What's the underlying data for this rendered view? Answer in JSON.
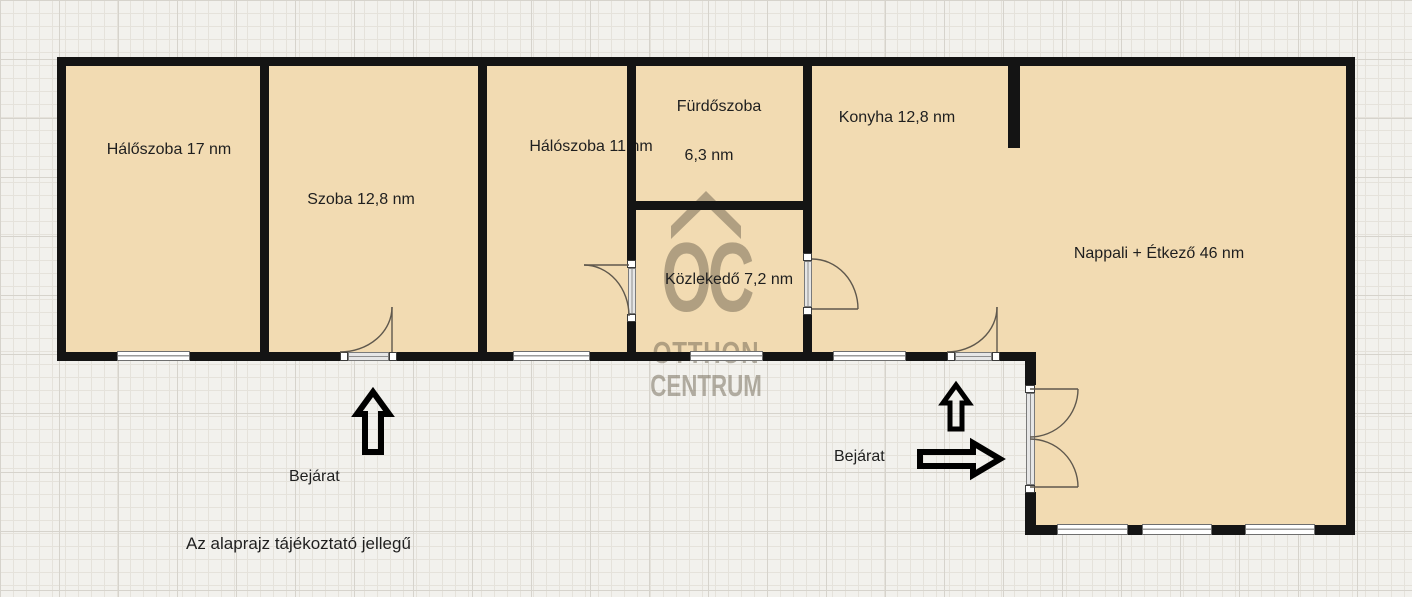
{
  "rooms": {
    "halo17": {
      "label": "Hálőszoba 17 nm"
    },
    "szoba": {
      "label": "Szoba 12,8 nm"
    },
    "halo11": {
      "label": "Hálószoba 11 nm"
    },
    "furdo": {
      "label": "Fürdőszoba",
      "area": "6,3 nm"
    },
    "konyha": {
      "label": "Konyha 12,8 nm"
    },
    "kozlekedo": {
      "label": "Közlekedő 7,2 nm"
    },
    "nappali": {
      "label": "Nappali + Étkező 46 nm"
    }
  },
  "annotations": {
    "entrance_left": "Bejárat",
    "entrance_right": "Bejárat",
    "disclaimer": "Az alaprajz tájékoztató jellegű"
  },
  "watermark": {
    "logo": "OC",
    "line1": "OTTHON",
    "line2": "CENTRUM"
  },
  "colors": {
    "background": "#f2f1ed",
    "grid_minor": "#e5e2db",
    "grid_major": "#d6d3cc",
    "room_fill": "#f2dbb2",
    "wall": "#141414",
    "watermark_color": "rgba(104,95,76,0.48)"
  }
}
